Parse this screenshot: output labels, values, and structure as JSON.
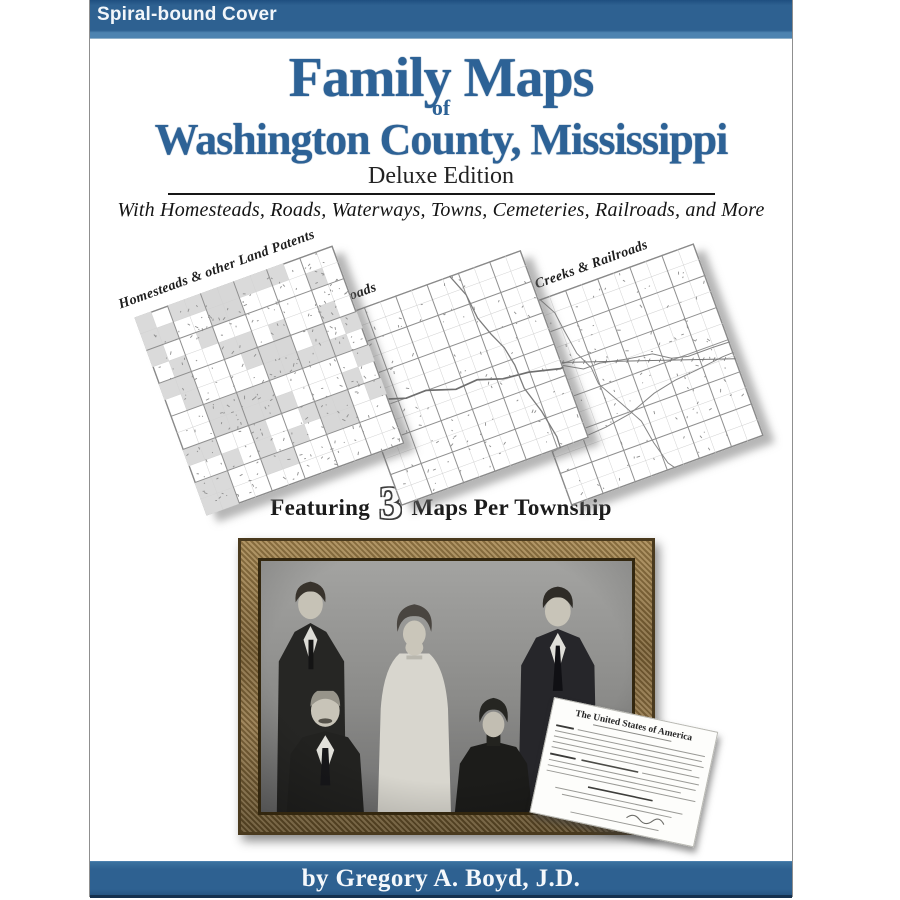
{
  "cover": {
    "badge": "Spiral-bound Cover",
    "title_line1": "Family Maps",
    "title_connector": "of",
    "title_line2": "Washington County, Mississippi",
    "edition": "Deluxe Edition",
    "tagline": "With Homesteads, Roads, Waterways, Towns, Cemeteries, Railroads, and More",
    "byline": "by Gregory A. Boyd, J.D."
  },
  "maps": {
    "items": [
      {
        "label": "Homesteads & other Land Patents"
      },
      {
        "label": "Roads"
      },
      {
        "label": "Rivers, Creeks & Railroads"
      }
    ],
    "featuring_prefix": "Featuring",
    "featuring_number": "3",
    "featuring_suffix": "Maps Per Township"
  },
  "patent": {
    "heading": "The United States of America"
  },
  "colors": {
    "bar_blue": "#2e6191",
    "title_blue": "#2d6296"
  }
}
